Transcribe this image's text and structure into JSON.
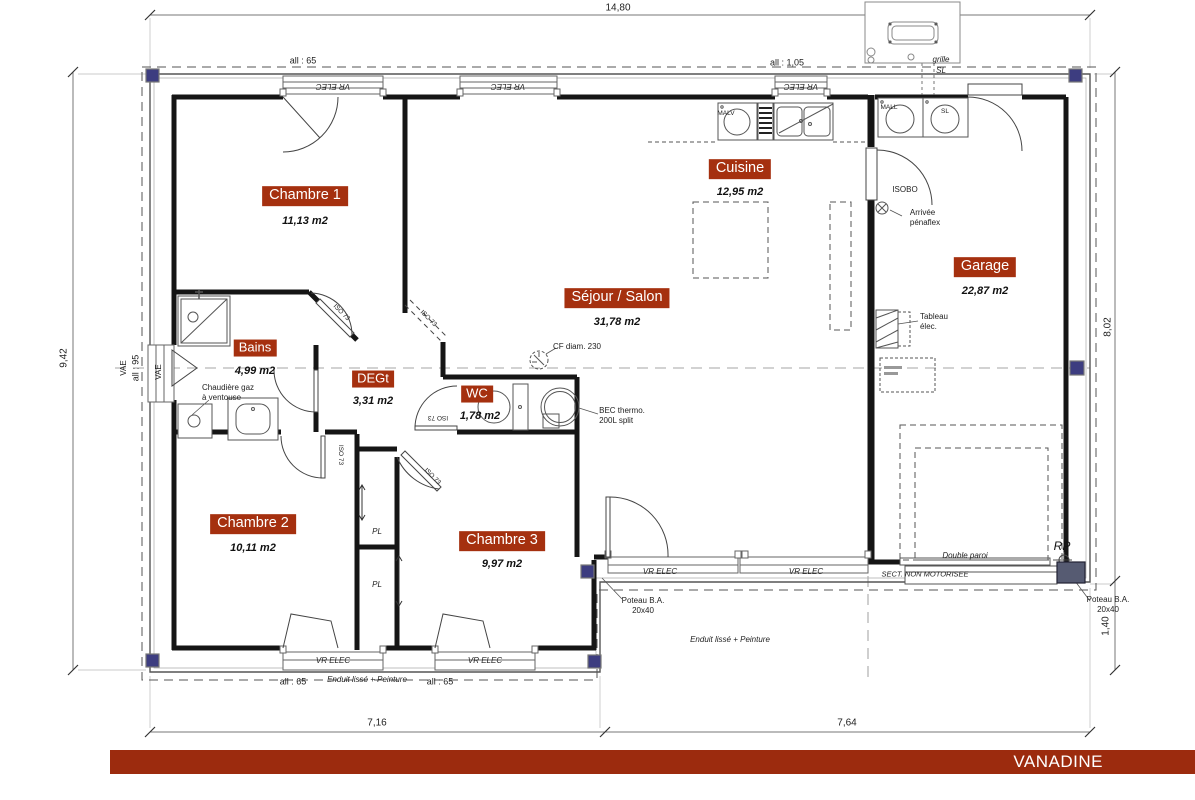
{
  "brand": {
    "name": "VANADINE"
  },
  "colors": {
    "badge": "#A5300F",
    "brand_bar": "#9C2B0E",
    "poteau": "#3D3D80"
  },
  "rooms": [
    {
      "id": "chambre1",
      "label": "Chambre 1",
      "area": "11,13 m2"
    },
    {
      "id": "cuisine",
      "label": "Cuisine",
      "area": "12,95 m2"
    },
    {
      "id": "sejour",
      "label": "Séjour / Salon",
      "area": "31,78 m2"
    },
    {
      "id": "garage",
      "label": "Garage",
      "area": "22,87 m2"
    },
    {
      "id": "bains",
      "label": "Bains",
      "area": "4,99 m2"
    },
    {
      "id": "degt",
      "label": "DEGt",
      "area": "3,31 m2"
    },
    {
      "id": "wc",
      "label": "WC",
      "area": "1,78 m2"
    },
    {
      "id": "chambre2",
      "label": "Chambre 2",
      "area": "10,11 m2"
    },
    {
      "id": "chambre3",
      "label": "Chambre 3",
      "area": "9,97 m2"
    }
  ],
  "dimensions": {
    "width_total": "14,80",
    "height_left": "9,42",
    "height_right": "8,02",
    "right_lower": "1,40",
    "bottom_left": "7,16",
    "bottom_right": "7,64"
  },
  "annotations": {
    "vr_elec": "VR ELEC",
    "all_65": "all : 65",
    "all_105": "all : 1,05",
    "all_95": "all : 95",
    "vae": "VAE",
    "iso_73": "ISO 73",
    "isobo": "ISOBO",
    "pl": "PL",
    "chaudiere": "Chaudière gaz\nà ventouse",
    "cf": "CF diam. 230",
    "bec": "BEC thermo.\n200L split",
    "arrivee": "Arrivée\npénaflex",
    "tableau": "Tableau\nélec.",
    "grille": "grille",
    "sl": "SL",
    "mall": "MALL",
    "malv": "MALV",
    "double_paroi": "Double paroi",
    "sect": "SECT.  NON MOTORISEE",
    "rp": "RP",
    "poteau_ba": "Poteau B.A.\n20x40",
    "enduit": "Enduit lissé + Peinture"
  }
}
